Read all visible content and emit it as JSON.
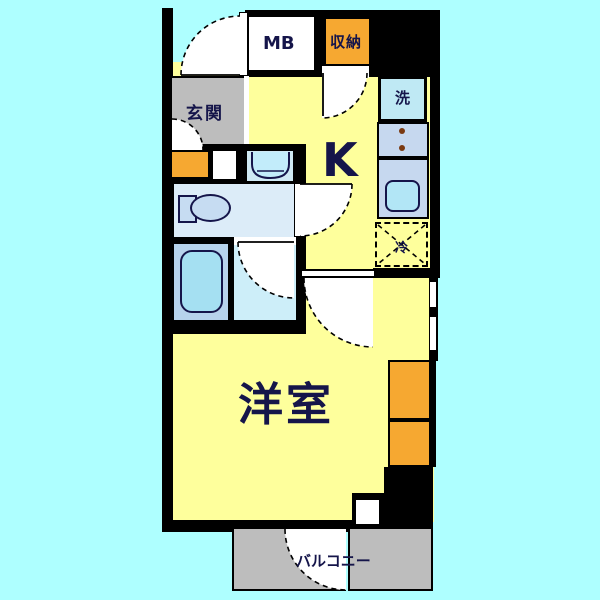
{
  "title": "apartment-floor-plan",
  "labels": {
    "genkan": "玄関",
    "meter_box": "MB",
    "storage": "収納",
    "washer": "洗",
    "kitchen": "K",
    "fridge": "冷",
    "western_room": "洋室",
    "balcony": "バルコニー"
  },
  "colors": {
    "background": "#aeffff",
    "wall": "#000000",
    "room_yellow": "#feff9c",
    "accent_orange": "#f6a831",
    "balcony_gray": "#bdbdbd",
    "fixture_blue": "#bfe9f4",
    "counter_blue": "#c6d8ef",
    "bath_blue": "#b7d3ec",
    "shower_tile_blue": "#cdeef9",
    "toilet_room_blue": "#dcecf8",
    "text_navy": "#15154a"
  }
}
